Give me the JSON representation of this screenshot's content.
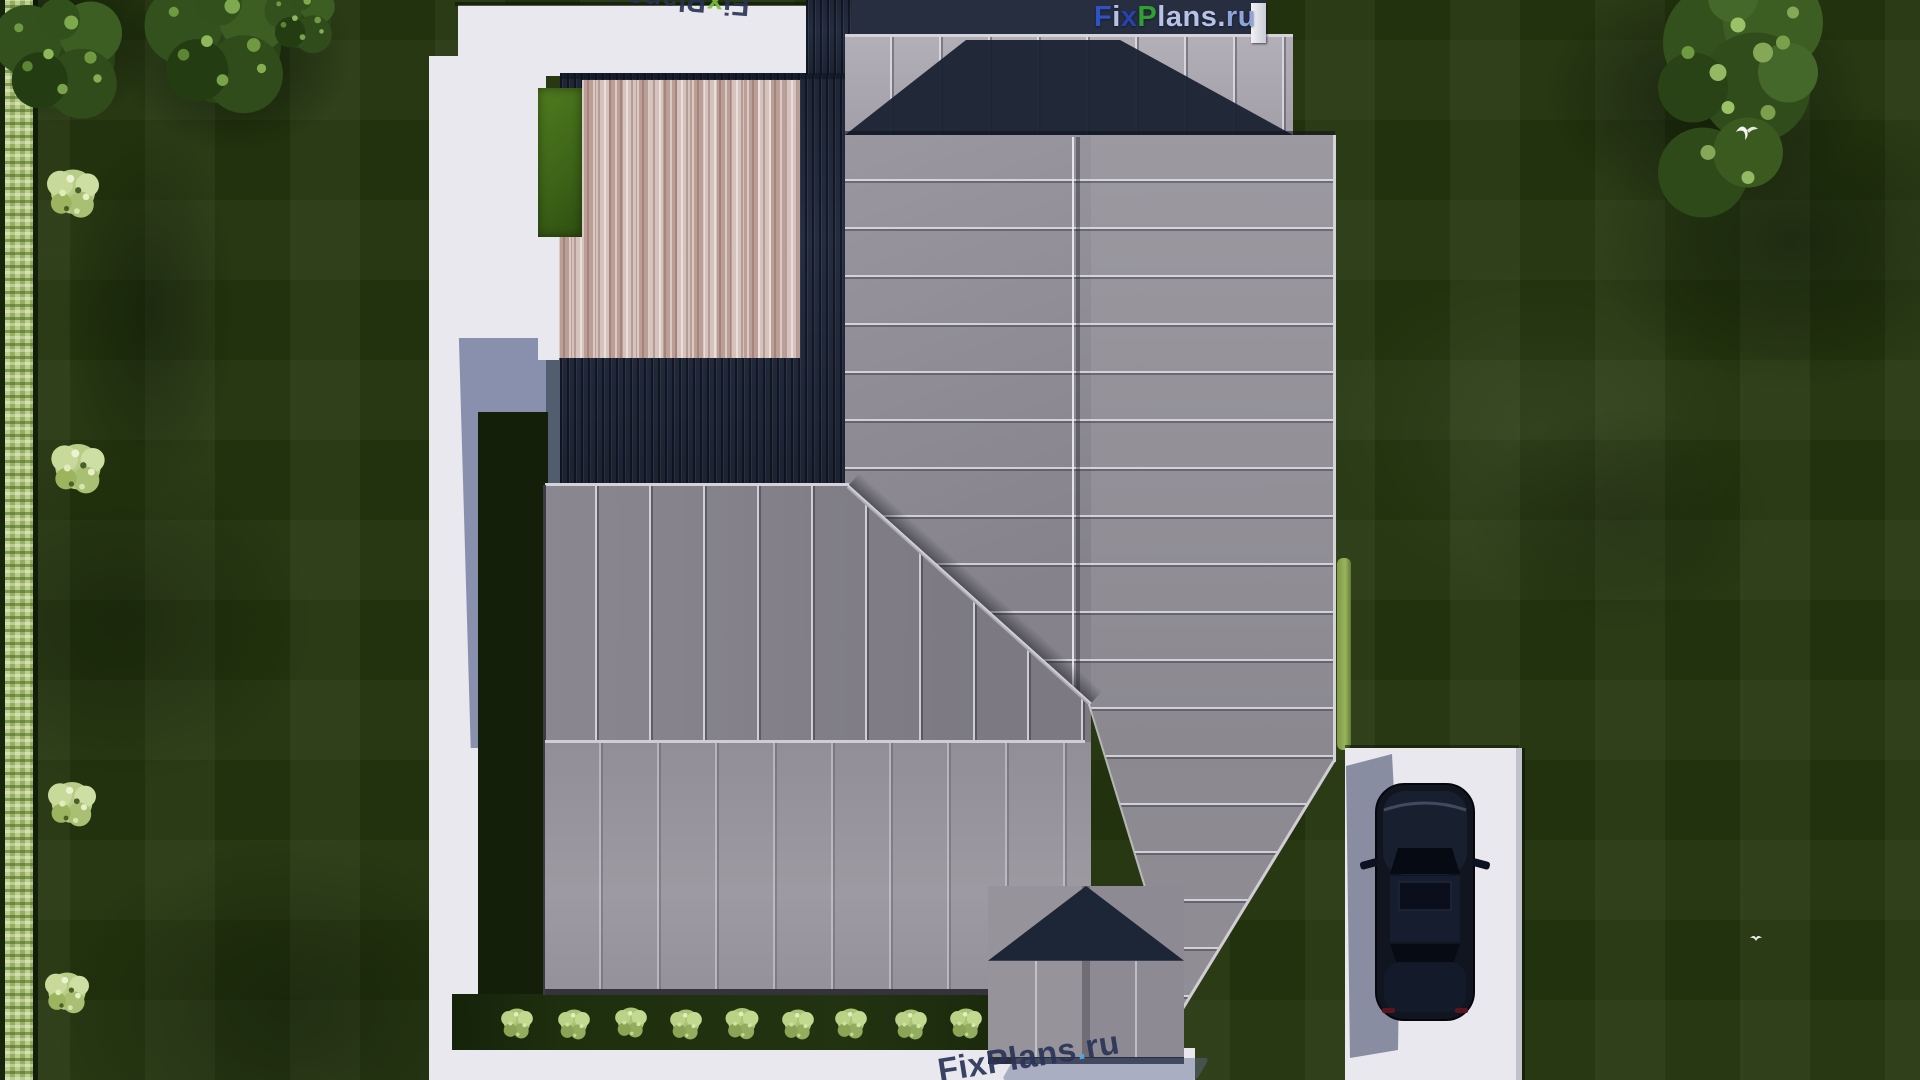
{
  "brand": "FixPlans.ru",
  "watermarks": {
    "logo_top_right": {
      "text": "FixPlans.ru",
      "letters": [
        {
          "ch": "F",
          "color": "#2d53c4"
        },
        {
          "ch": "i",
          "color": "#b6c2e6"
        },
        {
          "ch": "x",
          "color": "#2443ae"
        },
        {
          "ch": "P",
          "color": "#2f9e33"
        },
        {
          "ch": "l",
          "color": "#b6c2e6"
        },
        {
          "ch": "a",
          "color": "#b6c2e6"
        },
        {
          "ch": "n",
          "color": "#b6c2e6"
        },
        {
          "ch": "s",
          "color": "#b6c2e6"
        },
        {
          "ch": ".",
          "color": "#b6c2e6"
        },
        {
          "ch": "r",
          "color": "#8ea4da"
        },
        {
          "ch": "u",
          "color": "#8ea4da"
        }
      ]
    },
    "stamp_top_rotated": {
      "text": "FixPlans.ru",
      "rotation_deg": 184,
      "letters": [
        {
          "ch": "F",
          "color": "#273355"
        },
        {
          "ch": "i",
          "color": "#273355"
        },
        {
          "ch": "x",
          "color": "#7cbf3f"
        },
        {
          "ch": "P",
          "color": "#273355"
        },
        {
          "ch": "l",
          "color": "#273355"
        },
        {
          "ch": "a",
          "color": "#273355"
        },
        {
          "ch": "n",
          "color": "#273355"
        },
        {
          "ch": "s",
          "color": "#273355"
        },
        {
          "ch": ".",
          "color": "#7cbf3f"
        },
        {
          "ch": "r",
          "color": "#273355"
        },
        {
          "ch": "u",
          "color": "#273355"
        }
      ]
    },
    "stamp_bottom": {
      "text": "FixPlans.ru",
      "rotation_deg": -9,
      "letters": [
        {
          "ch": "F",
          "color": "#2a3457"
        },
        {
          "ch": "i",
          "color": "#2a3457"
        },
        {
          "ch": "x",
          "color": "#2a3457"
        },
        {
          "ch": "P",
          "color": "#2a3457"
        },
        {
          "ch": "l",
          "color": "#2a3457"
        },
        {
          "ch": "a",
          "color": "#2a3457"
        },
        {
          "ch": "n",
          "color": "#2a3457"
        },
        {
          "ch": "s",
          "color": "#2a3457"
        },
        {
          "ch": ".",
          "color": "#55a8e2"
        },
        {
          "ch": "r",
          "color": "#2a3457"
        },
        {
          "ch": "u",
          "color": "#2a3457"
        }
      ]
    }
  },
  "colors": {
    "grass_base": "#25370f",
    "grass_shadow": "#141f0a",
    "path_concrete": "#e8e8ee",
    "roof_gray": "#8f8c95",
    "roof_top_gray": "#aca9b1",
    "roof_shadow_navy": "#1b2333",
    "deck_wood_navy": "#222a3c",
    "pergola_wood": "#c9b1aa",
    "hedge_light_green": "#a6bd71",
    "bush_light_green": "#c3d794",
    "car_body": "#10151f",
    "building_shadow_blue": "#8f98b6",
    "logo_blue": "#2d53c4",
    "logo_green": "#2f9e33",
    "logo_light_blue": "#b6c2e6",
    "stamp_navy": "#2a3457"
  }
}
